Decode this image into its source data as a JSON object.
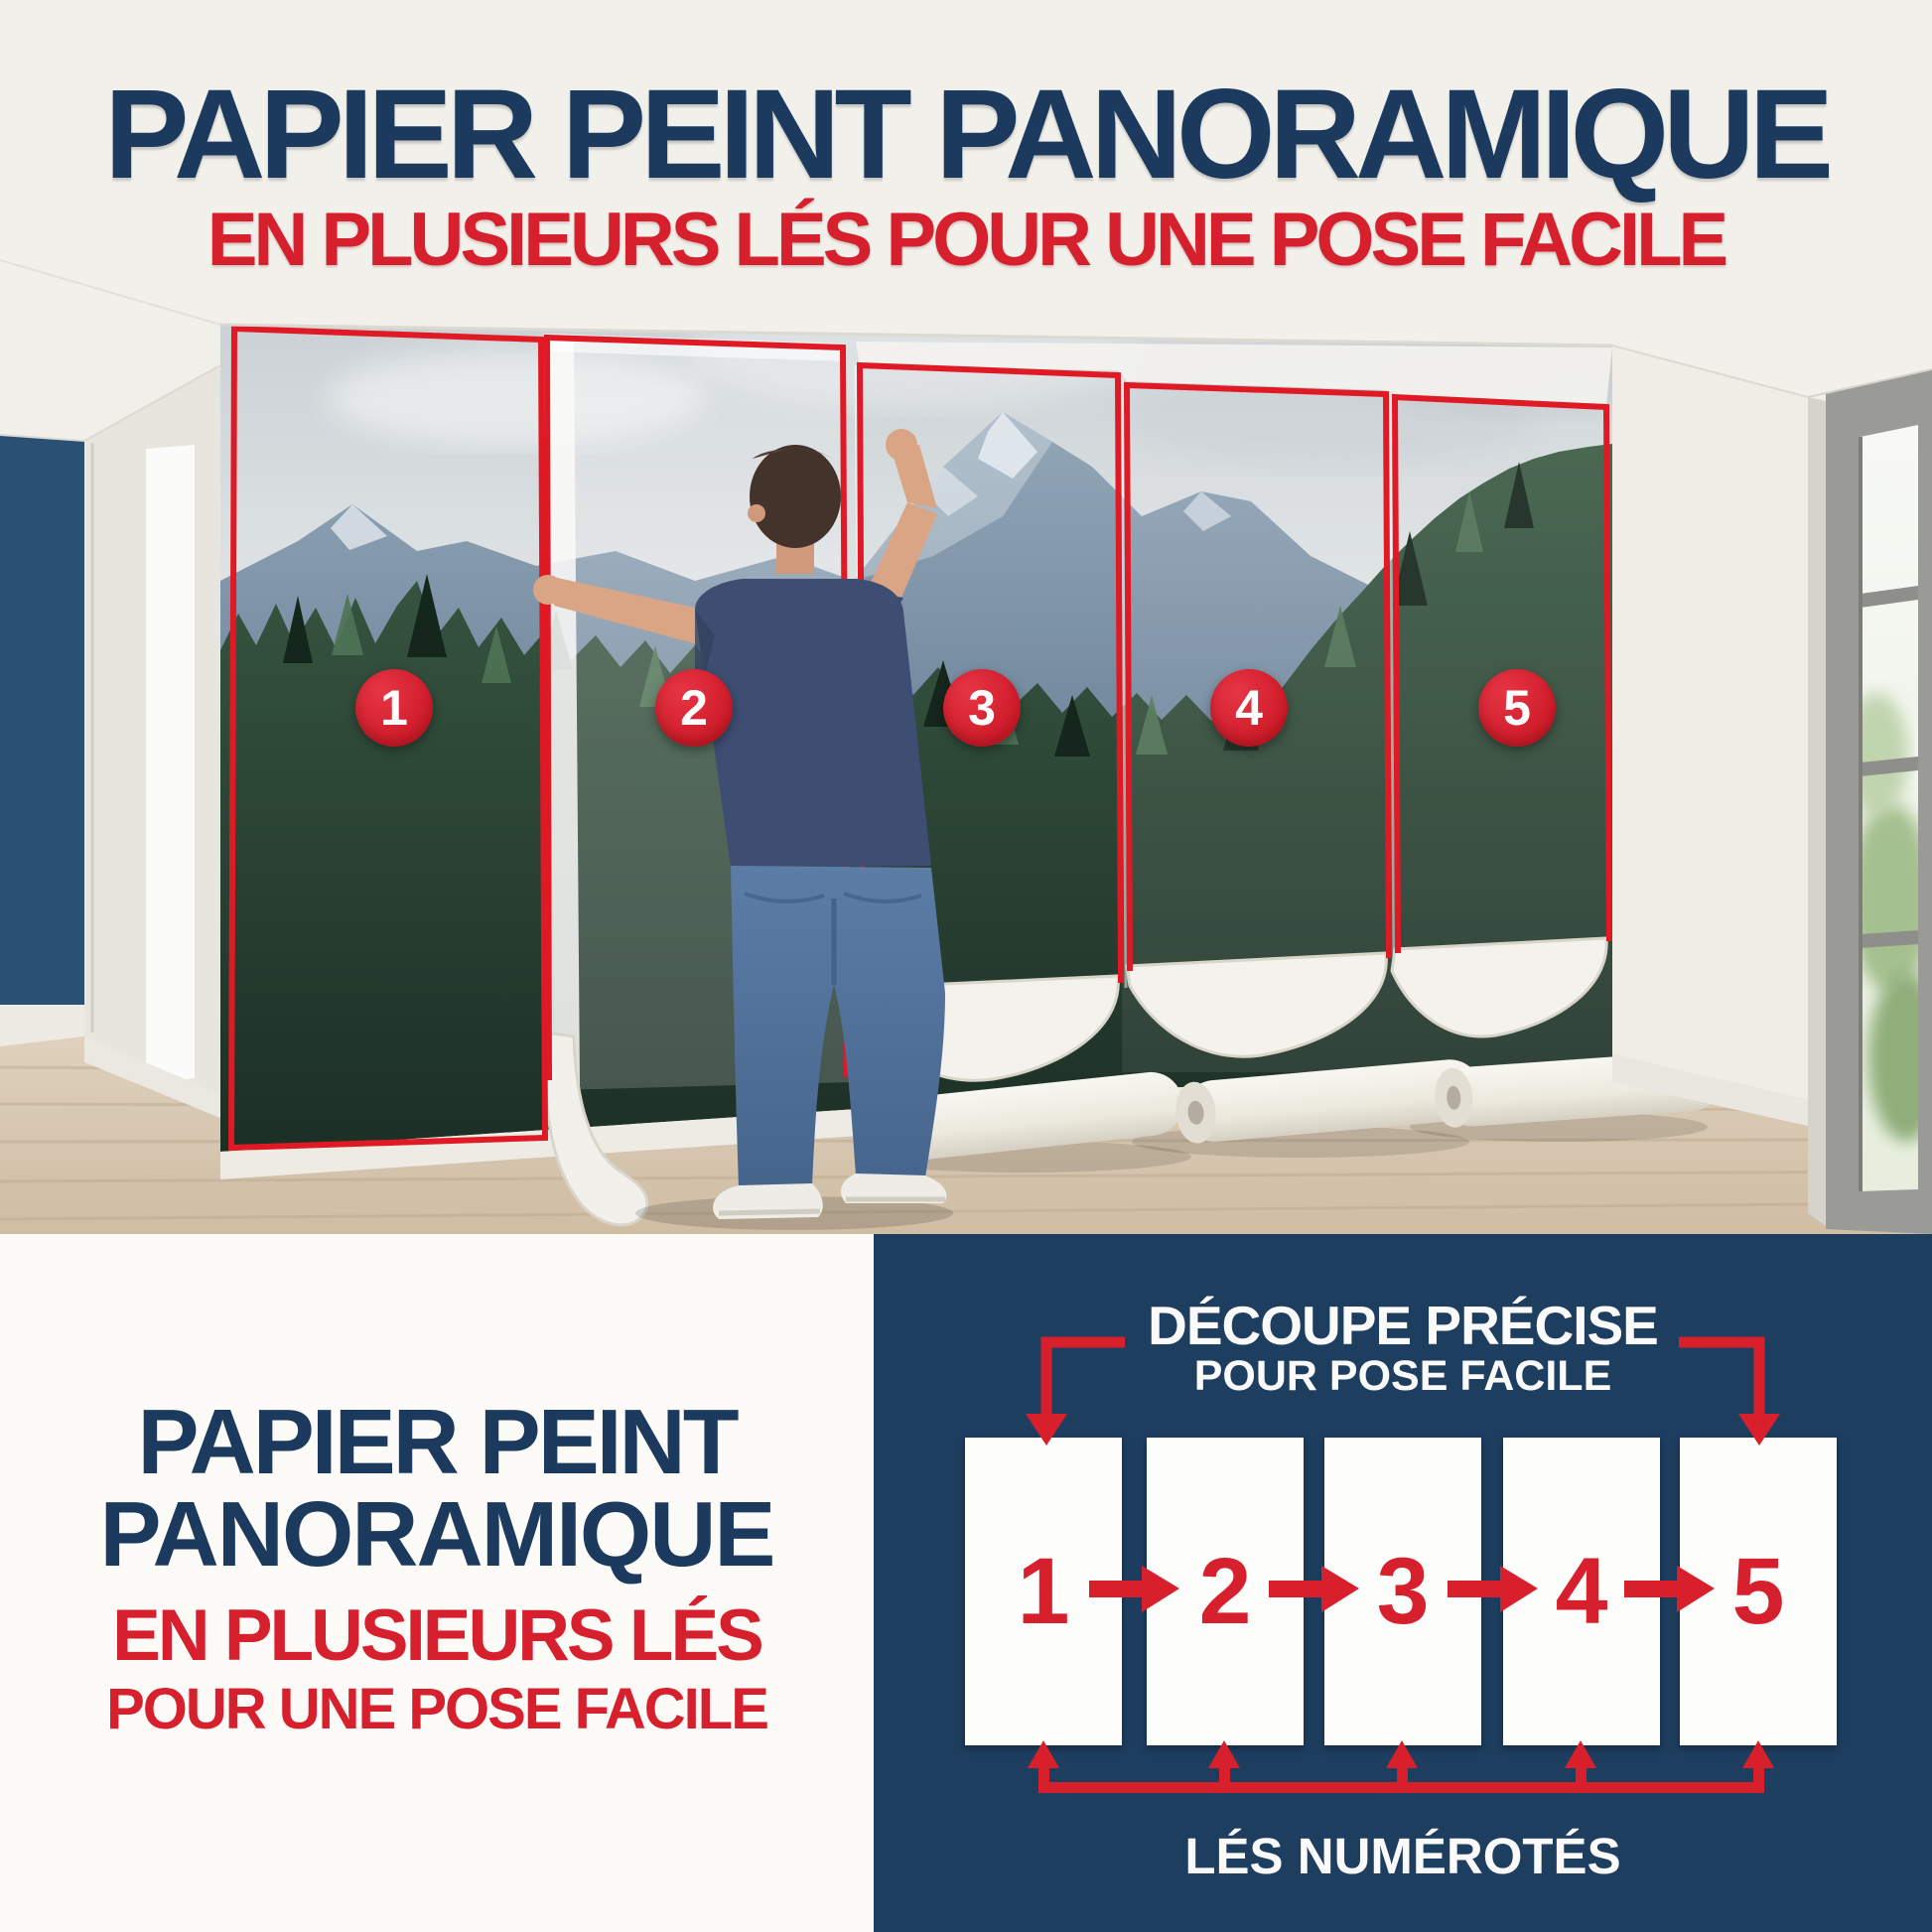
{
  "header": {
    "title": "PAPIER PEINT PANORAMIQUE",
    "subtitle": "EN PLUSIEURS LÉS POUR UNE POSE FACILE"
  },
  "photo": {
    "description": "man installing panoramic mountain-forest wallpaper in 5 numbered strips",
    "badges": [
      "1",
      "2",
      "3",
      "4",
      "5"
    ]
  },
  "bottom_left": {
    "title_line1": "PAPIER PEINT",
    "title_line2": "PANORAMIQUE",
    "subtitle_line1": "EN PLUSIEURS LÉS",
    "subtitle_line2": "POUR UNE POSE FACILE"
  },
  "diagram": {
    "title_line1": "DÉCOUPE PRÉCISE",
    "title_line2": "POUR POSE FACILE",
    "strips": [
      "1",
      "2",
      "3",
      "4",
      "5"
    ],
    "caption": "LÉS NUMÉROTÉS"
  },
  "colors": {
    "navy_text": "#1c3a5e",
    "red": "#d7202e",
    "panel_navy": "#1e3e60",
    "accent_wall_blue": "#2a5173",
    "background": "#f1efe9"
  }
}
